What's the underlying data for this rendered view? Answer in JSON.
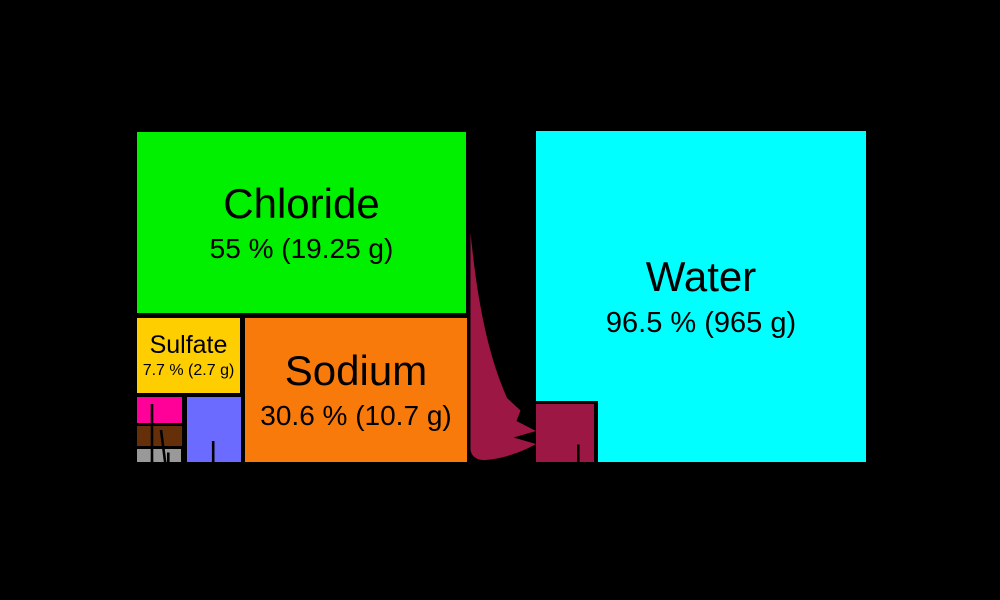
{
  "canvas": {
    "background": "#000000",
    "text_color": "#000000"
  },
  "boxes": {
    "chloride": {
      "label": "Chloride",
      "sub": "55 % (19.25 g)",
      "color": "#00F000"
    },
    "sodium": {
      "label": "Sodium",
      "sub": "30.6 % (10.7 g)",
      "color": "#F87A0A"
    },
    "sulfate": {
      "label": "Sulfate",
      "sub": "7.7 % (2.7 g)",
      "color": "#FFCE00"
    },
    "magenta_small": {
      "label": "",
      "color": "#FF0099"
    },
    "blue_small": {
      "label": "",
      "color": "#6B6BFF"
    },
    "brown_small": {
      "label": "",
      "color": "#653009"
    },
    "gray_small": {
      "label": "",
      "color": "#999999"
    }
  },
  "water": {
    "label": "Water",
    "sub": "96.5 % (965 g)",
    "color": "#00FFFF"
  },
  "inner_salts_square": {
    "color": "#9C1743"
  },
  "arrow": {
    "color": "#9C1743"
  },
  "chart_data": {
    "type": "treemap",
    "title": "",
    "groups": [
      {
        "name": "left-square-dissolved-salts",
        "items": [
          {
            "label": "Chloride",
            "percent": 55,
            "mass_g": 19.25,
            "color": "#00F000"
          },
          {
            "label": "Sodium",
            "percent": 30.6,
            "mass_g": 10.7,
            "color": "#F87A0A"
          },
          {
            "label": "Sulfate",
            "percent": 7.7,
            "mass_g": 2.7,
            "color": "#FFCE00"
          },
          {
            "label": "",
            "percent_est_from_area": 3.4,
            "color": "#6B6BFF"
          },
          {
            "label": "",
            "percent_est_from_area": 1.2,
            "color": "#FF0099"
          },
          {
            "label": "",
            "percent_est_from_area": 1.1,
            "color": "#653009"
          },
          {
            "label": "",
            "percent_est_from_area": 0.7,
            "color": "#999999"
          }
        ]
      },
      {
        "name": "right-square-seawater",
        "items": [
          {
            "label": "Water",
            "percent": 96.5,
            "mass_g": 965,
            "color": "#00FFFF"
          },
          {
            "label": "",
            "percent_est_from_area": 3.5,
            "color": "#9C1743"
          }
        ]
      }
    ],
    "layout_hints": {
      "arrow": "curved maroon arrow from right edge of left square pointing to small maroon square inside bottom-left of water square",
      "leader_line_ticks": "short black line stubs enter small boxes from below (labels outside visible area)"
    }
  }
}
